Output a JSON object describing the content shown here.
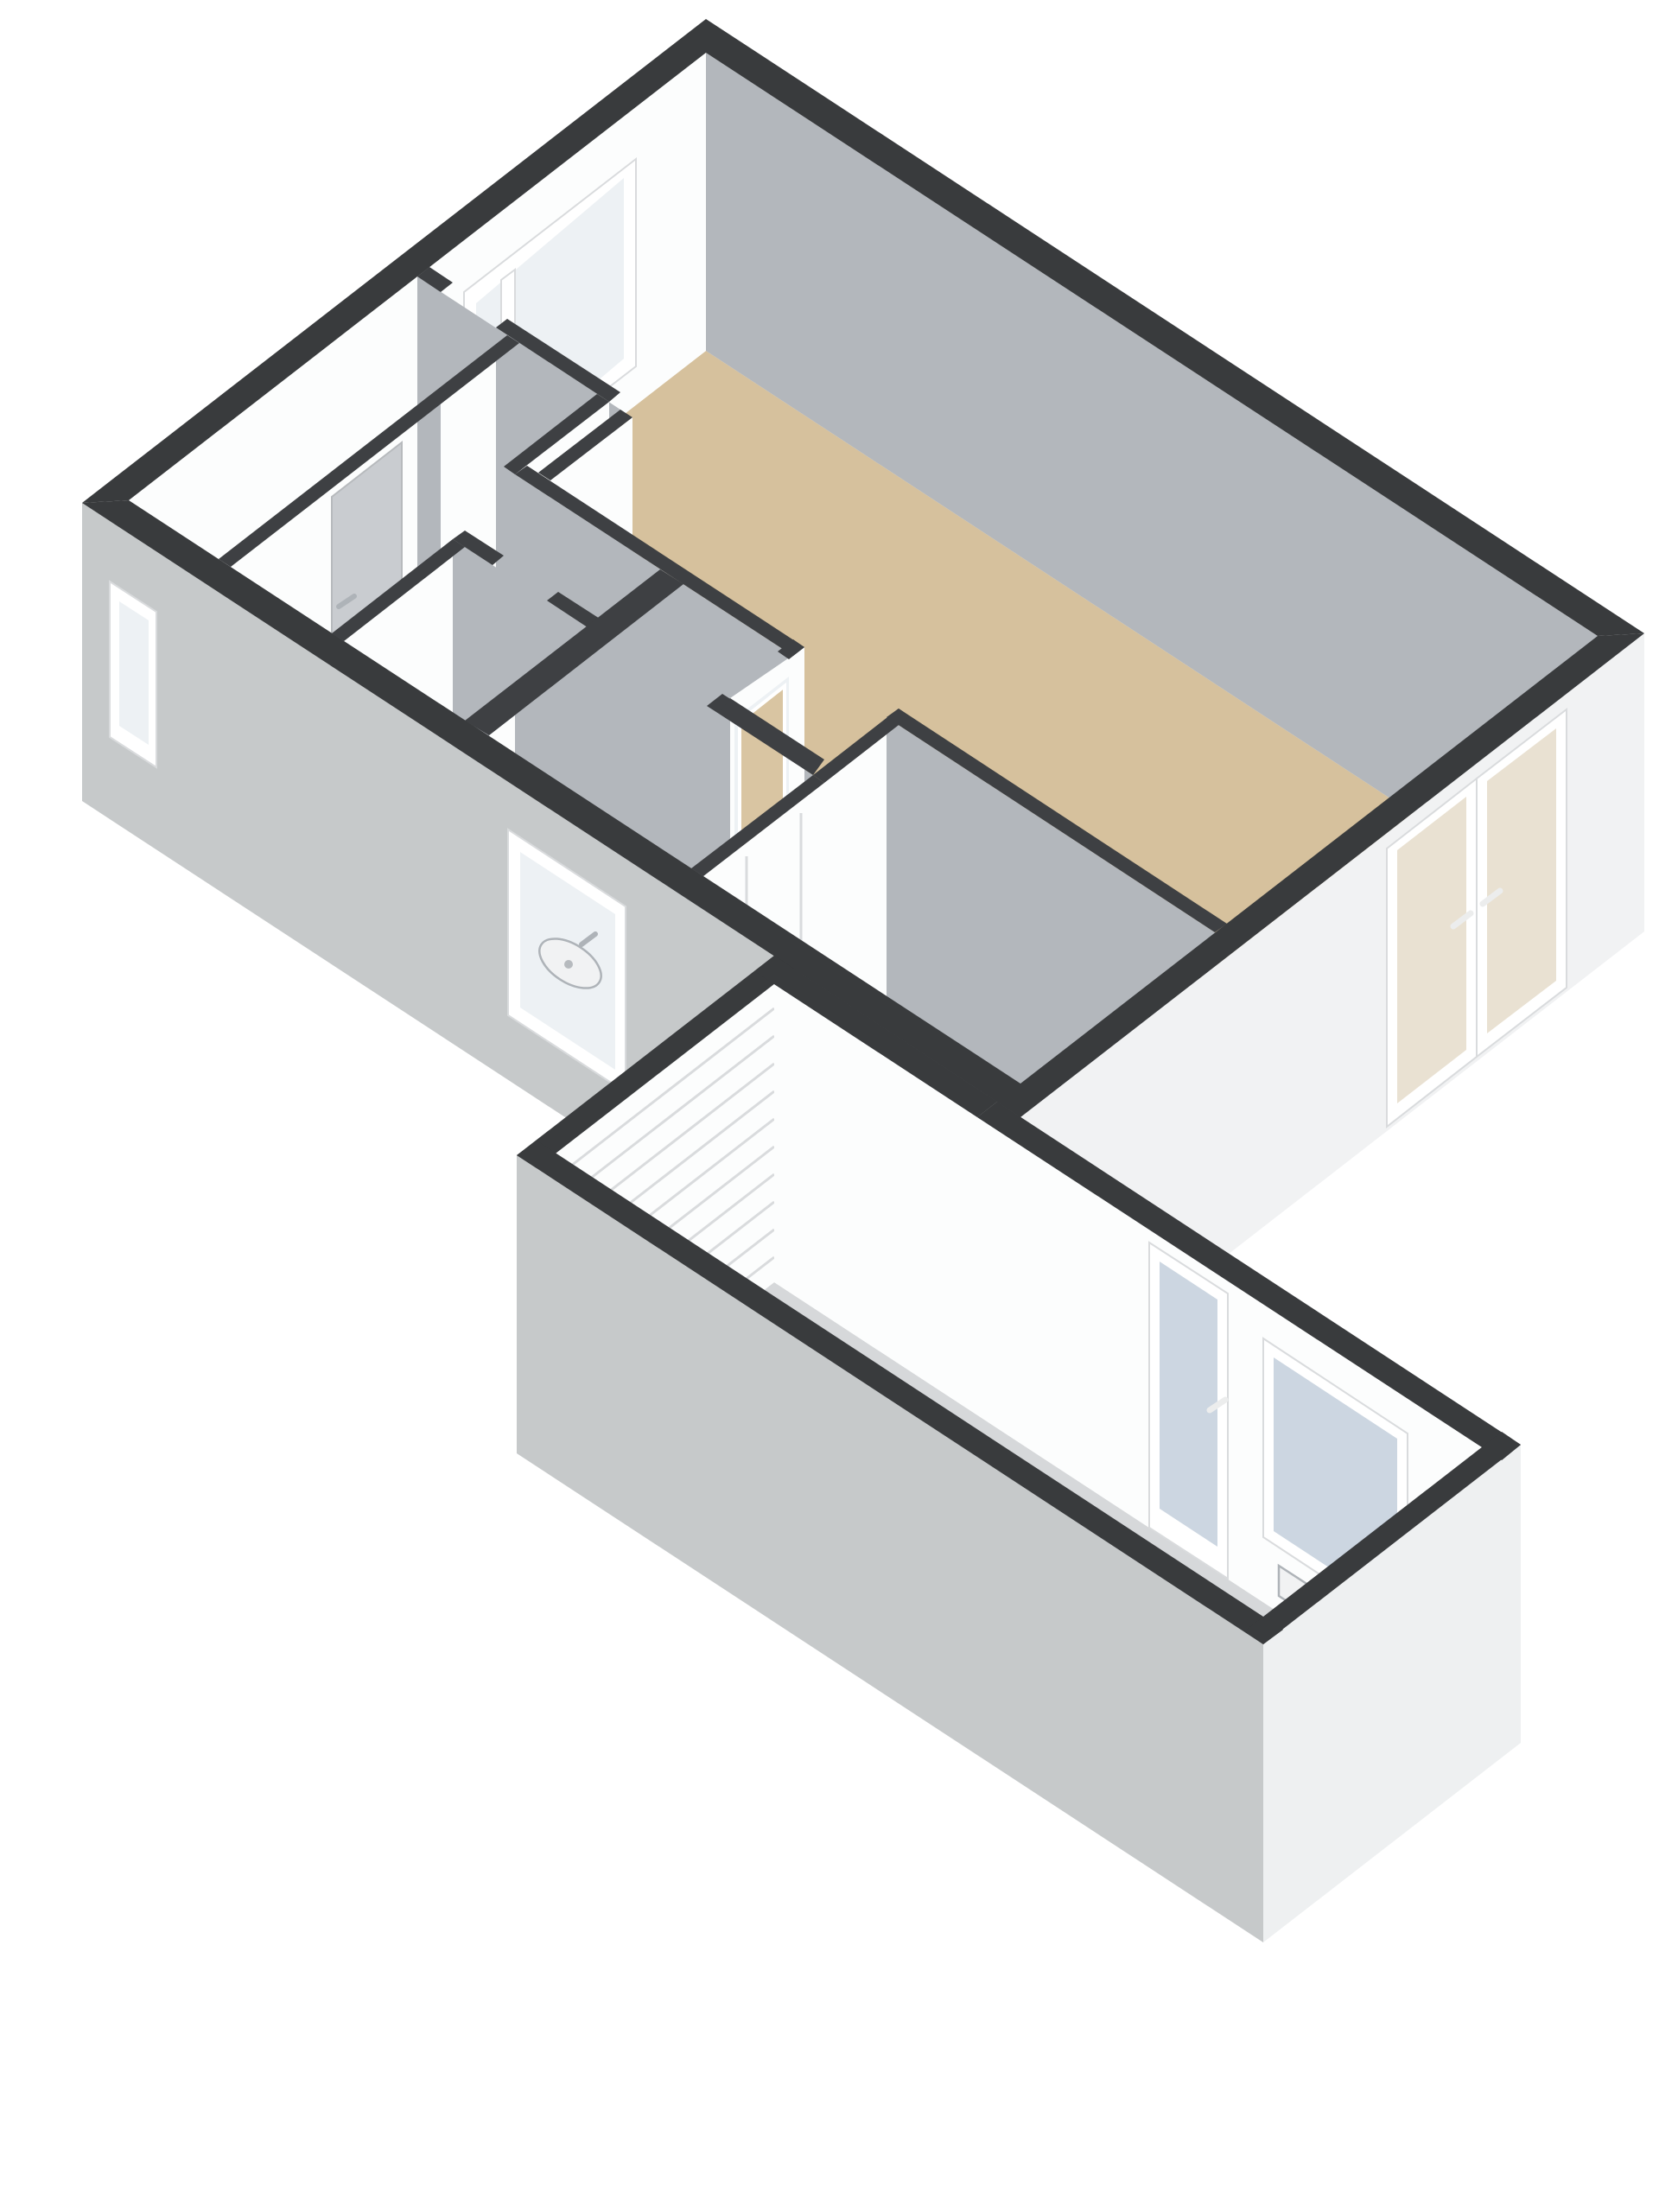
{
  "meta": {
    "title": "3D floor plan render, ground floor with attached garage, isometric top-down view",
    "type": "floorplan-3d",
    "background": "#ffffff"
  },
  "colors": {
    "bg": "#ffffff",
    "wall_top": "#393b3d",
    "wall_top_interior": "#3e4043",
    "exterior_shaded": "#c6c9ca",
    "exterior_lit": "#f1f2f3",
    "exterior_lit2": "#eef0f1",
    "interior_lit": "#fcfdfd",
    "interior_shadow": "#b3b7bc",
    "floor_wood": "#d6c19d",
    "floor_blue": "#ccd6e2",
    "floor_light": "#f3f4f5",
    "floor_garage": "#d6d8da",
    "frame_white": "#ffffff",
    "frame_edge": "#d9dbdd",
    "glass": "#edf1f4",
    "glass_blue": "#ccd6e1",
    "glass_warm": "#e9e1d2",
    "door_gray": "#c9ccd0",
    "door_tan": "#d9c5a2",
    "chrome": "#aeb3b8",
    "mark_white": "#eceded",
    "roller_slat": "#d9dbdd",
    "fixture_white": "#f1f2f3"
  },
  "scene": {
    "blocks": [
      {
        "name": "main-house",
        "floors": [
          "living-room-wood",
          "hallway-wood",
          "bathroom-blue",
          "bedroom-blue",
          "wc-white",
          "storage-white"
        ]
      },
      {
        "name": "garage-wing",
        "floors": [
          "garage-gray"
        ]
      }
    ],
    "openings": [
      {
        "name": "living-room-window",
        "wall": "north-west"
      },
      {
        "name": "small-wc-window",
        "wall": "south-west"
      },
      {
        "name": "bathroom-window",
        "wall": "south-west"
      },
      {
        "name": "french-doors",
        "wall": "south-east"
      },
      {
        "name": "garage-glazed-door",
        "wall": "garage-north-east"
      },
      {
        "name": "garage-window",
        "wall": "garage-north-east"
      },
      {
        "name": "garage-roller-door",
        "wall": "garage-north-west"
      },
      {
        "name": "hall-interior-door",
        "state": "closed"
      },
      {
        "name": "bathroom-interior-door",
        "state": "open"
      },
      {
        "name": "bedroom-interior-door",
        "state": "closed"
      }
    ],
    "fixtures": [
      {
        "name": "bathroom-sink"
      },
      {
        "name": "wc-toilet"
      },
      {
        "name": "garage-radiator"
      }
    ]
  }
}
